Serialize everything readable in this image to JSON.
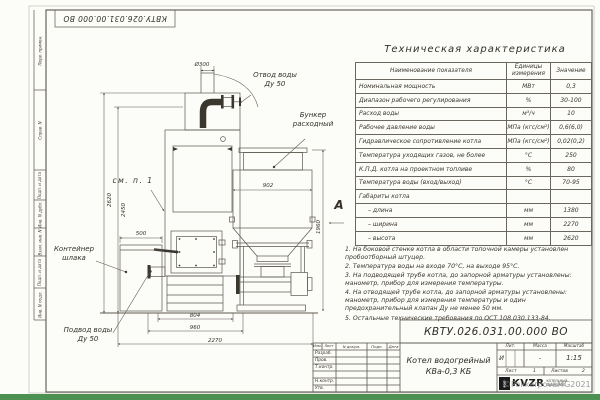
{
  "colors": {
    "paper": "#fcfcf8",
    "line": "#5b574e",
    "ink": "#34312b",
    "accent_green": "#4c9152",
    "watermark_gray": "#8b8b8b"
  },
  "frame": {
    "side_labels": [
      "Перв. примен.",
      "Справ. N",
      "Подп. и дата",
      "Инв. N дубл.",
      "Взам. инв. N",
      "Подп. и дата",
      "Инв. N подл."
    ]
  },
  "drawing": {
    "labels": {
      "outlet_l1": "Отвод воды",
      "outlet_l2": "Ду 50",
      "bunker_l1": "Бункер",
      "bunker_l2": "расходный",
      "see_note": "см. п. 1",
      "slag_l1": "Контейнер",
      "slag_l2": "шлака",
      "inlet_l1": "Подвод воды",
      "inlet_l2": "Ду 50",
      "view_marker": "А"
    },
    "dims": {
      "chimney_dia": "Ø300",
      "total_height": "2620",
      "body_height": "2450",
      "slag_width": "500",
      "bunker_width": "902",
      "bunker_height": "1960",
      "base_width": "804",
      "frame_width": "960",
      "overall_width": "2270"
    }
  },
  "tech_table": {
    "title": "Техническая характеристика",
    "headers": [
      "Наименование показателя",
      "Единицы измерения",
      "Значение"
    ],
    "rows": [
      {
        "name": "Номинальная мощность",
        "unit": "МВт",
        "value": "0,3"
      },
      {
        "name": "Диапазон рабочего регулирования",
        "unit": "%",
        "value": "30-100"
      },
      {
        "name": "Расход воды",
        "unit": "м³/ч",
        "value": "10"
      },
      {
        "name": "Рабочее давление воды",
        "unit": "МПа (кгс/см²)",
        "value": "0,6(6,0)"
      },
      {
        "name": "Гидравлическое сопротивление котла",
        "unit": "МПа (кгс/см²)",
        "value": "0,02(0,2)"
      },
      {
        "name": "Температура уходящих газов, не более",
        "unit": "°С",
        "value": "250"
      },
      {
        "name": "К.П.Д. котла на проектном топливе",
        "unit": "%",
        "value": "80"
      },
      {
        "name": "Температура воды (вход/выход)",
        "unit": "°С",
        "value": "70-95"
      },
      {
        "name": "Габариты котла",
        "unit": "",
        "value": ""
      },
      {
        "name": "– длина",
        "unit": "мм",
        "value": "1380"
      },
      {
        "name": "– ширина",
        "unit": "мм",
        "value": "2270"
      },
      {
        "name": "– высота",
        "unit": "мм",
        "value": "2620"
      }
    ]
  },
  "notes": {
    "items": [
      "1. На боковой стенке котла в области топочной камеры установлен пробоотборный штуцер.",
      "2. Температура воды на входе 70°С, на выходе 95°С.",
      "3. На подводящей трубе котла, до запорной арматуры установлены: манометр, прибор для измерения температуры.",
      "4. На отводящей трубе котла, до запорной арматуры установлены: манометр, прибор для измерения температуры и один предохранительный клапан Ду не менее 50 мм.",
      "5. Остальные технические требования по ОСТ 108.030.133-84."
    ]
  },
  "title_block": {
    "doc_number": "КВТУ.026.031.00.000  ВО",
    "header_cells": [
      "Изм.",
      "Лист",
      "N докум.",
      "Подп.",
      "Дата"
    ],
    "row_labels": [
      "Разраб.",
      "Пров.",
      "Т.контр.",
      "",
      "Н.контр.",
      "Утв."
    ],
    "product_l1": "Котел водогрейный",
    "product_l2": "КВа-0,3 КБ",
    "lit_label": "Лит.",
    "mass_label": "Масса",
    "scale_label": "Масштаб",
    "lit_value": "И",
    "mass_value": "-",
    "scale_value": "1:15",
    "sheet_label": "Лист",
    "sheet_value": "1",
    "sheets_label": "Листов",
    "sheets_value": "2",
    "logo_text": "KVZR",
    "logo_icon_text": "РЭП",
    "logo_sub_l1": "КОТЕЛЬНЫЙ",
    "logo_sub_l2": "ЗАВОД РЭП",
    "watermark": "©PolikarpovaMG2021"
  }
}
